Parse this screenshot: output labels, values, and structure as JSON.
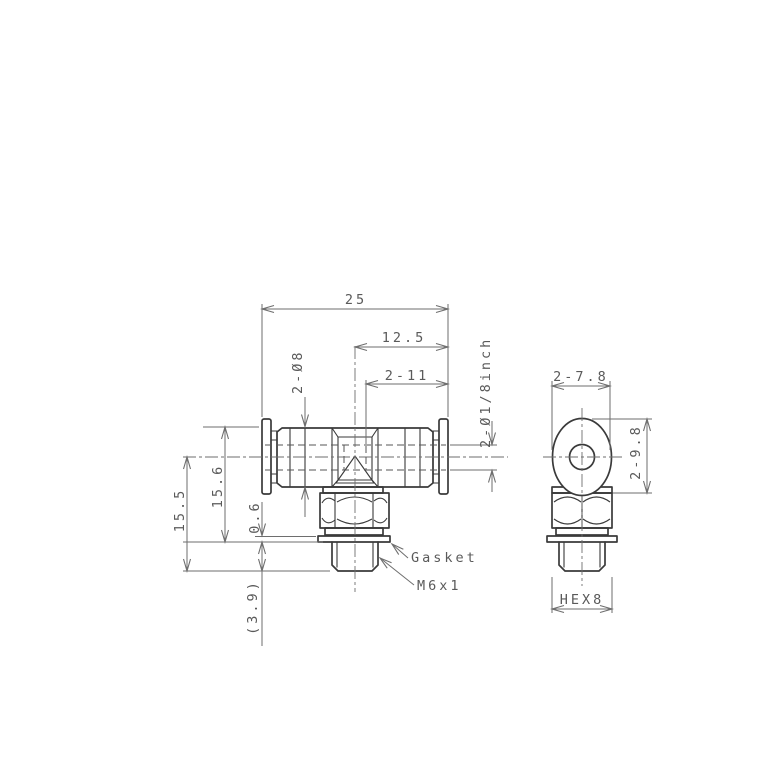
{
  "page": {
    "background": "#ffffff"
  },
  "drawing": {
    "part_line_color": "#3a3a3a",
    "dim_line_color": "#6e6e6e",
    "text_color": "#5a5a5a",
    "front_view": {
      "dim_overall_width": "25",
      "dim_center_to_end": "12.5",
      "dim_tube_insertion_depth": "2-11",
      "dim_body_diameter": "2-Ø8",
      "dim_tube_size": "2-Ø1/8inch",
      "dim_top_to_seat_height": "15.6",
      "dim_center_to_thread_end": "15.5",
      "dim_gasket_thickness": "0.6",
      "dim_thread_length": "(3.9)",
      "label_gasket": "Gasket",
      "label_thread_spec": "M6x1"
    },
    "side_view": {
      "dim_release_ring_width": "2-7.8",
      "dim_release_ring_height": "2-9.8",
      "dim_hex_across_flats": "HEX8"
    }
  }
}
